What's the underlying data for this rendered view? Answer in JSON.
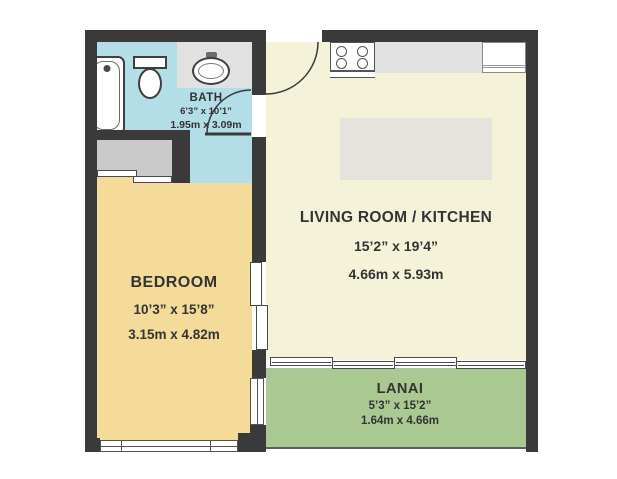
{
  "title": "One-bedroom apartment floor plan",
  "rooms": {
    "bath": {
      "name": "BATH",
      "dim_ft": "6’3” x 10’1”",
      "dim_m": "1.95m x 3.09m",
      "color": "#b3dde7"
    },
    "bedroom": {
      "name": "BEDROOM",
      "dim_ft": "10’3” x 15’8”",
      "dim_m": "3.15m x 4.82m",
      "color": "#f5db99"
    },
    "living": {
      "name": "LIVING ROOM / KITCHEN",
      "dim_ft": "15’2” x 19’4”",
      "dim_m": "4.66m x 5.93m",
      "color": "#f5f2da"
    },
    "lanai": {
      "name": "LANAI",
      "dim_ft": "5’3” x 15’2”",
      "dim_m": "1.64m x 4.66m",
      "color": "#aac892"
    }
  },
  "fixtures": [
    "bathtub",
    "shower-head",
    "toilet",
    "bathroom-sink",
    "closet-sliding-doors",
    "stove",
    "kitchen-counter",
    "refrigerator",
    "kitchen-island",
    "entry-door",
    "bath-door",
    "pocket-door",
    "lanai-sliding-doors",
    "windows"
  ],
  "palette": {
    "wall": "#3a3a3a",
    "counter": "#e1e1e1",
    "closet": "#cacaca",
    "island": "#e4e4dd",
    "fixture_outline": "#3f3f3f",
    "text": "#333333",
    "background": "#ffffff"
  }
}
